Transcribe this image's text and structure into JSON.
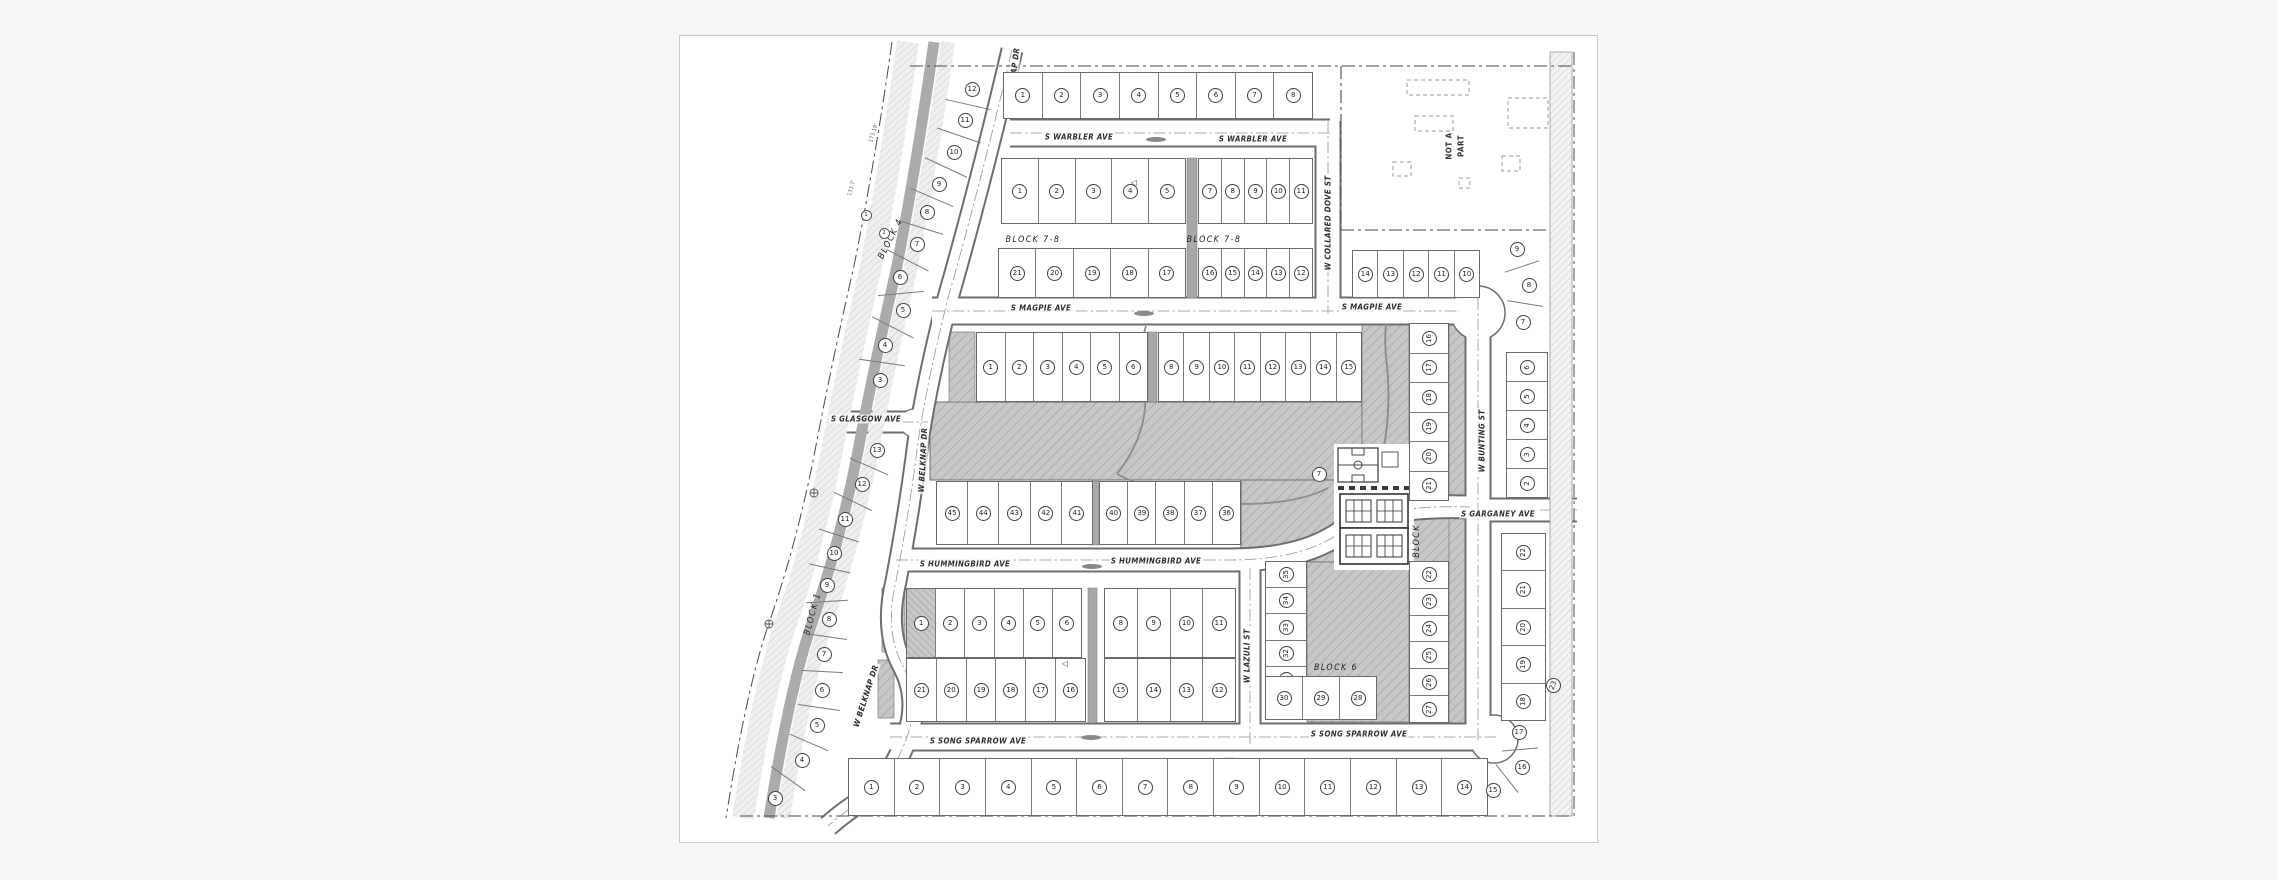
{
  "map": {
    "type": "subdivision-plat-drawing",
    "colors": {
      "background": "#f7f7f7",
      "panel_border": "#c9c9c9",
      "line": "#6a6a6a",
      "park_fill": "#c7c7c7",
      "canal_band": "#ababab"
    },
    "street_labels": [
      {
        "id": "wa1",
        "text": "S WARBLER AVE"
      },
      {
        "id": "wa2",
        "text": "S WARBLER AVE"
      },
      {
        "id": "ma1",
        "text": "S MAGPIE AVE"
      },
      {
        "id": "ma2",
        "text": "S MAGPIE AVE"
      },
      {
        "id": "gl",
        "text": "S GLASGOW AVE"
      },
      {
        "id": "hu1",
        "text": "S HUMMINGBIRD AVE"
      },
      {
        "id": "hu2",
        "text": "S HUMMINGBIRD AVE"
      },
      {
        "id": "ss1",
        "text": "S SONG SPARROW AVE"
      },
      {
        "id": "ss2",
        "text": "S SONG SPARROW AVE"
      },
      {
        "id": "ga",
        "text": "S GARGANEY AVE"
      },
      {
        "id": "cd",
        "text": "W COLLARED DOVE ST"
      },
      {
        "id": "bu",
        "text": "W BUNTING ST"
      },
      {
        "id": "lz",
        "text": "W LAZULI ST"
      },
      {
        "id": "bk1",
        "text": "W BELKNAP DR"
      },
      {
        "id": "bk2",
        "text": "W BELKNAP DR"
      },
      {
        "id": "bk3",
        "text": "W BELKNAP DR"
      }
    ],
    "block_labels": [
      {
        "id": "b9",
        "text": "BLOCK 9"
      },
      {
        "id": "b78w",
        "text": "BLOCK 7-8"
      },
      {
        "id": "b78e",
        "text": "BLOCK 7-8"
      },
      {
        "id": "b6uw",
        "text": "BLOCK 6"
      },
      {
        "id": "b6ue",
        "text": "BLOCK 6"
      },
      {
        "id": "b6lw",
        "text": "BLOCK 6"
      },
      {
        "id": "b6lc",
        "text": "BLOCK 6"
      },
      {
        "id": "b6am",
        "text": "BLOCK 6"
      },
      {
        "id": "b45",
        "text": "BLOCK 4-5"
      },
      {
        "id": "b10",
        "text": "BLOCK 10"
      },
      {
        "id": "b3r",
        "text": "BLOCK 3"
      },
      {
        "id": "b1",
        "text": "BLOCK 1"
      },
      {
        "id": "b4",
        "text": "BLOCK 4"
      },
      {
        "id": "b3bw",
        "text": "BLOCK 3"
      },
      {
        "id": "b3be",
        "text": "BLOCK 3"
      },
      {
        "id": "bamv",
        "text": "BLOCK"
      }
    ],
    "area_labels": [
      {
        "id": "nap1",
        "text": "NOT A"
      },
      {
        "id": "nap2",
        "text": "PART"
      }
    ],
    "survey_labels": [
      {
        "id": "c1",
        "text": "173.18'"
      },
      {
        "id": "c2",
        "text": "133.7'"
      }
    ],
    "lot_rows": [
      {
        "id": "b9",
        "block": "9",
        "lots": [
          "1",
          "2",
          "3",
          "4",
          "5",
          "6",
          "7",
          "8"
        ]
      },
      {
        "id": "b78wu",
        "block": "7-8",
        "lots": [
          "1",
          "2",
          "3",
          "4",
          "5"
        ]
      },
      {
        "id": "b78eu",
        "block": "7-8",
        "lots": [
          "7",
          "8",
          "9",
          "10",
          "11"
        ]
      },
      {
        "id": "b78wl",
        "block": "7-8",
        "lots": [
          "21",
          "20",
          "19",
          "18",
          "17"
        ]
      },
      {
        "id": "b78el",
        "block": "7-8",
        "lots": [
          "16",
          "15",
          "14",
          "13",
          "12"
        ]
      },
      {
        "id": "b10t",
        "block": "10",
        "lots": [
          "14",
          "13",
          "12",
          "11",
          "10"
        ]
      },
      {
        "id": "b10c",
        "block": "10",
        "lots": [
          "6",
          "5",
          "4",
          "3",
          "2"
        ]
      },
      {
        "id": "b6uw",
        "block": "6",
        "lots": [
          "1",
          "2",
          "3",
          "4",
          "5",
          "6"
        ]
      },
      {
        "id": "b6ue",
        "block": "6",
        "lots": [
          "8",
          "9",
          "10",
          "11",
          "12",
          "13",
          "14",
          "15"
        ]
      },
      {
        "id": "b6ca",
        "block": "6",
        "lots": [
          "16",
          "17",
          "18",
          "19",
          "20",
          "21"
        ]
      },
      {
        "id": "b6cb",
        "block": "6",
        "lots": [
          "22",
          "23",
          "24",
          "25",
          "26",
          "27"
        ]
      },
      {
        "id": "b6lw",
        "block": "6",
        "lots": [
          "45",
          "44",
          "43",
          "42",
          "41"
        ]
      },
      {
        "id": "b6lc",
        "block": "6",
        "lots": [
          "40",
          "39",
          "38",
          "37",
          "36"
        ]
      },
      {
        "id": "b6laz",
        "block": "6",
        "lots": [
          "35",
          "34",
          "33",
          "32",
          "31"
        ]
      },
      {
        "id": "b6bot",
        "block": "6",
        "lots": [
          "30",
          "29",
          "28"
        ]
      },
      {
        "id": "b45uw",
        "block": "4-5",
        "lots": [
          "1",
          "2",
          "3",
          "4",
          "5",
          "6"
        ]
      },
      {
        "id": "b45ue",
        "block": "4-5",
        "lots": [
          "8",
          "9",
          "10",
          "11"
        ]
      },
      {
        "id": "b45lw",
        "block": "4-5",
        "lots": [
          "21",
          "20",
          "19",
          "18",
          "17",
          "16"
        ]
      },
      {
        "id": "b45le",
        "block": "4-5",
        "lots": [
          "15",
          "14",
          "13",
          "12"
        ]
      },
      {
        "id": "b3c",
        "block": "3",
        "lots": [
          "22",
          "21",
          "20",
          "19",
          "18"
        ]
      },
      {
        "id": "b3b",
        "block": "3",
        "lots": [
          "1",
          "2",
          "3",
          "4",
          "5",
          "6",
          "7",
          "8",
          "9",
          "10",
          "11",
          "12",
          "13",
          "14"
        ]
      }
    ],
    "lot_singles": [
      {
        "id": "k12",
        "label": "12"
      },
      {
        "id": "k11",
        "label": "11"
      },
      {
        "id": "k10",
        "label": "10"
      },
      {
        "id": "k9",
        "label": "9"
      },
      {
        "id": "k8",
        "label": "8"
      },
      {
        "id": "k7",
        "label": "7"
      },
      {
        "id": "k6",
        "label": "6"
      },
      {
        "id": "k5",
        "label": "5"
      },
      {
        "id": "k4",
        "label": "4"
      },
      {
        "id": "k3",
        "label": "3"
      },
      {
        "id": "j13",
        "label": "13"
      },
      {
        "id": "j12",
        "label": "12"
      },
      {
        "id": "j11",
        "label": "11"
      },
      {
        "id": "j10",
        "label": "10"
      },
      {
        "id": "j9",
        "label": "9"
      },
      {
        "id": "j8",
        "label": "8"
      },
      {
        "id": "j7",
        "label": "7"
      },
      {
        "id": "j6",
        "label": "6"
      },
      {
        "id": "j5",
        "label": "5"
      },
      {
        "id": "j4",
        "label": "4"
      },
      {
        "id": "j3",
        "label": "3"
      },
      {
        "id": "n9",
        "label": "9"
      },
      {
        "id": "n8",
        "label": "8"
      },
      {
        "id": "n7",
        "label": "7"
      },
      {
        "id": "f17",
        "label": "17"
      },
      {
        "id": "f16",
        "label": "16"
      },
      {
        "id": "f15",
        "label": "15"
      },
      {
        "id": "r23",
        "label": "23"
      },
      {
        "id": "p7",
        "label": "7"
      },
      {
        "id": "m1",
        "label": "1"
      },
      {
        "id": "m2",
        "label": "2"
      }
    ],
    "icons": [
      {
        "id": "tri1",
        "glyph": "◁",
        "meaning": "plat-triangle-marker"
      },
      {
        "id": "tri2",
        "glyph": "◁",
        "meaning": "plat-triangle-marker"
      }
    ]
  }
}
